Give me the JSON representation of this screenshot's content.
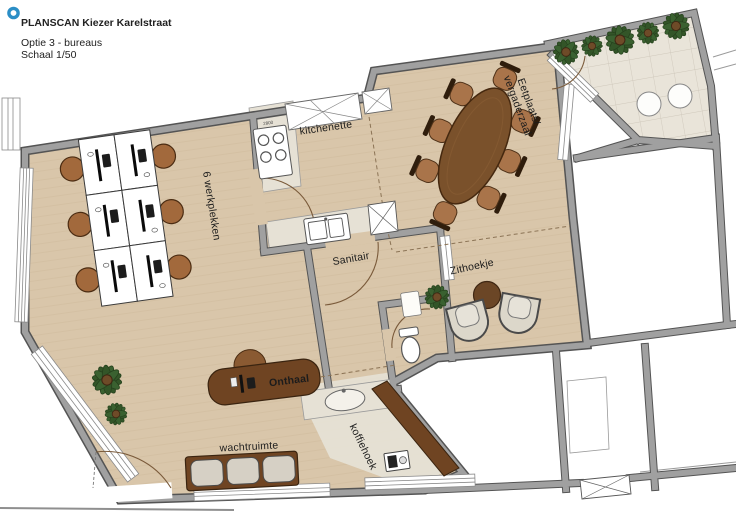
{
  "header": {
    "title": "PLANSCAN Kiezer Karelstraat",
    "option": "Optie 3 - bureaus",
    "scale": "Schaal 1/50",
    "logo_color": "#2b8ec6"
  },
  "rooms": {
    "office": {
      "label": "6 werkplekken",
      "desk_count": 6
    },
    "kitchenette": {
      "label": "kitchenette",
      "stove_label": "2800"
    },
    "meeting": {
      "label_line1": "Eetplaats/",
      "label_line2": "vergaderzaal",
      "seat_count": 8
    },
    "sanitary": {
      "label": "Sanitair"
    },
    "lounge": {
      "label": "Zithoekje"
    },
    "reception": {
      "label": "Onthaal"
    },
    "waiting": {
      "label": "wachtruimte",
      "seat_count": 3
    },
    "coffee": {
      "label": "koffiehoek"
    }
  },
  "icons": {
    "logo": "ring-icon",
    "plants": "plant-icon"
  },
  "colors": {
    "floor_tan": "#d9c6aa",
    "floor_grain": "#c9b493",
    "wall_gray": "#a0a0a0",
    "wall_edge": "#545454",
    "terrace_tile": "#e9e4d9",
    "tile_line": "#cfc8bb",
    "stone": "#e6e1d5",
    "wood_dark": "#6f4422",
    "wood_table": "#7a512b",
    "chair_brown": "#a2693c",
    "cushion": "#d6d0c5",
    "armchair": "#dcd7ca",
    "plant_green": "#335528",
    "white_room": "#ffffff"
  }
}
